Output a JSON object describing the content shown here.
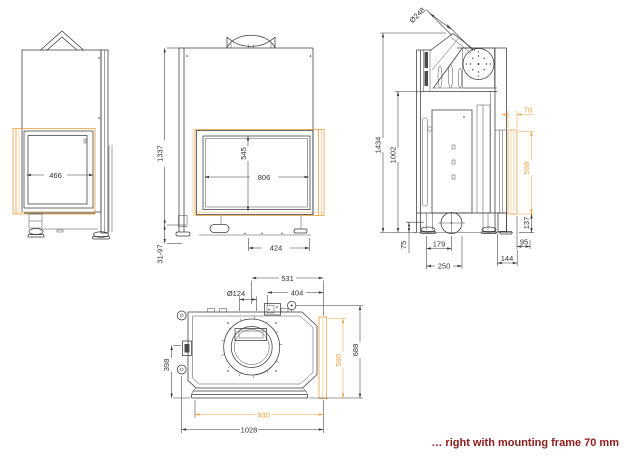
{
  "caption": "… right with mounting frame 70 mm",
  "colors": {
    "line": "#3a3a3a",
    "accent_orange": "#EC9F3E",
    "accent_orange_light": "#F3CD9C",
    "caption_red": "#8E1A1A"
  },
  "views": {
    "left_side": {
      "dims": {
        "glass_width": "466"
      }
    },
    "front": {
      "dims": {
        "overall_height": "1337",
        "foot_adjust_range": "31-97",
        "glass_height": "545",
        "glass_width": "806",
        "base_width": "424"
      }
    },
    "right_side": {
      "dims": {
        "flue_diameter": "Ø248",
        "overall_height": "1434",
        "body_height": "1002",
        "mounting_frame_width": "70",
        "mounting_frame_height": "598",
        "frame_bottom_offset": "137",
        "plinth_height": "75",
        "flue_center_depth": "179",
        "base_depth": "250",
        "rear_depth": "144",
        "side_offset": "95"
      }
    },
    "plan": {
      "dims": {
        "flue_center_x": "531",
        "intake_center_x": "404",
        "intake_diameter": "Ø124",
        "side_glass_depth": "398",
        "frame_depth": "590",
        "overall_depth": "688",
        "frame_width": "930",
        "overall_width": "1028"
      }
    }
  }
}
